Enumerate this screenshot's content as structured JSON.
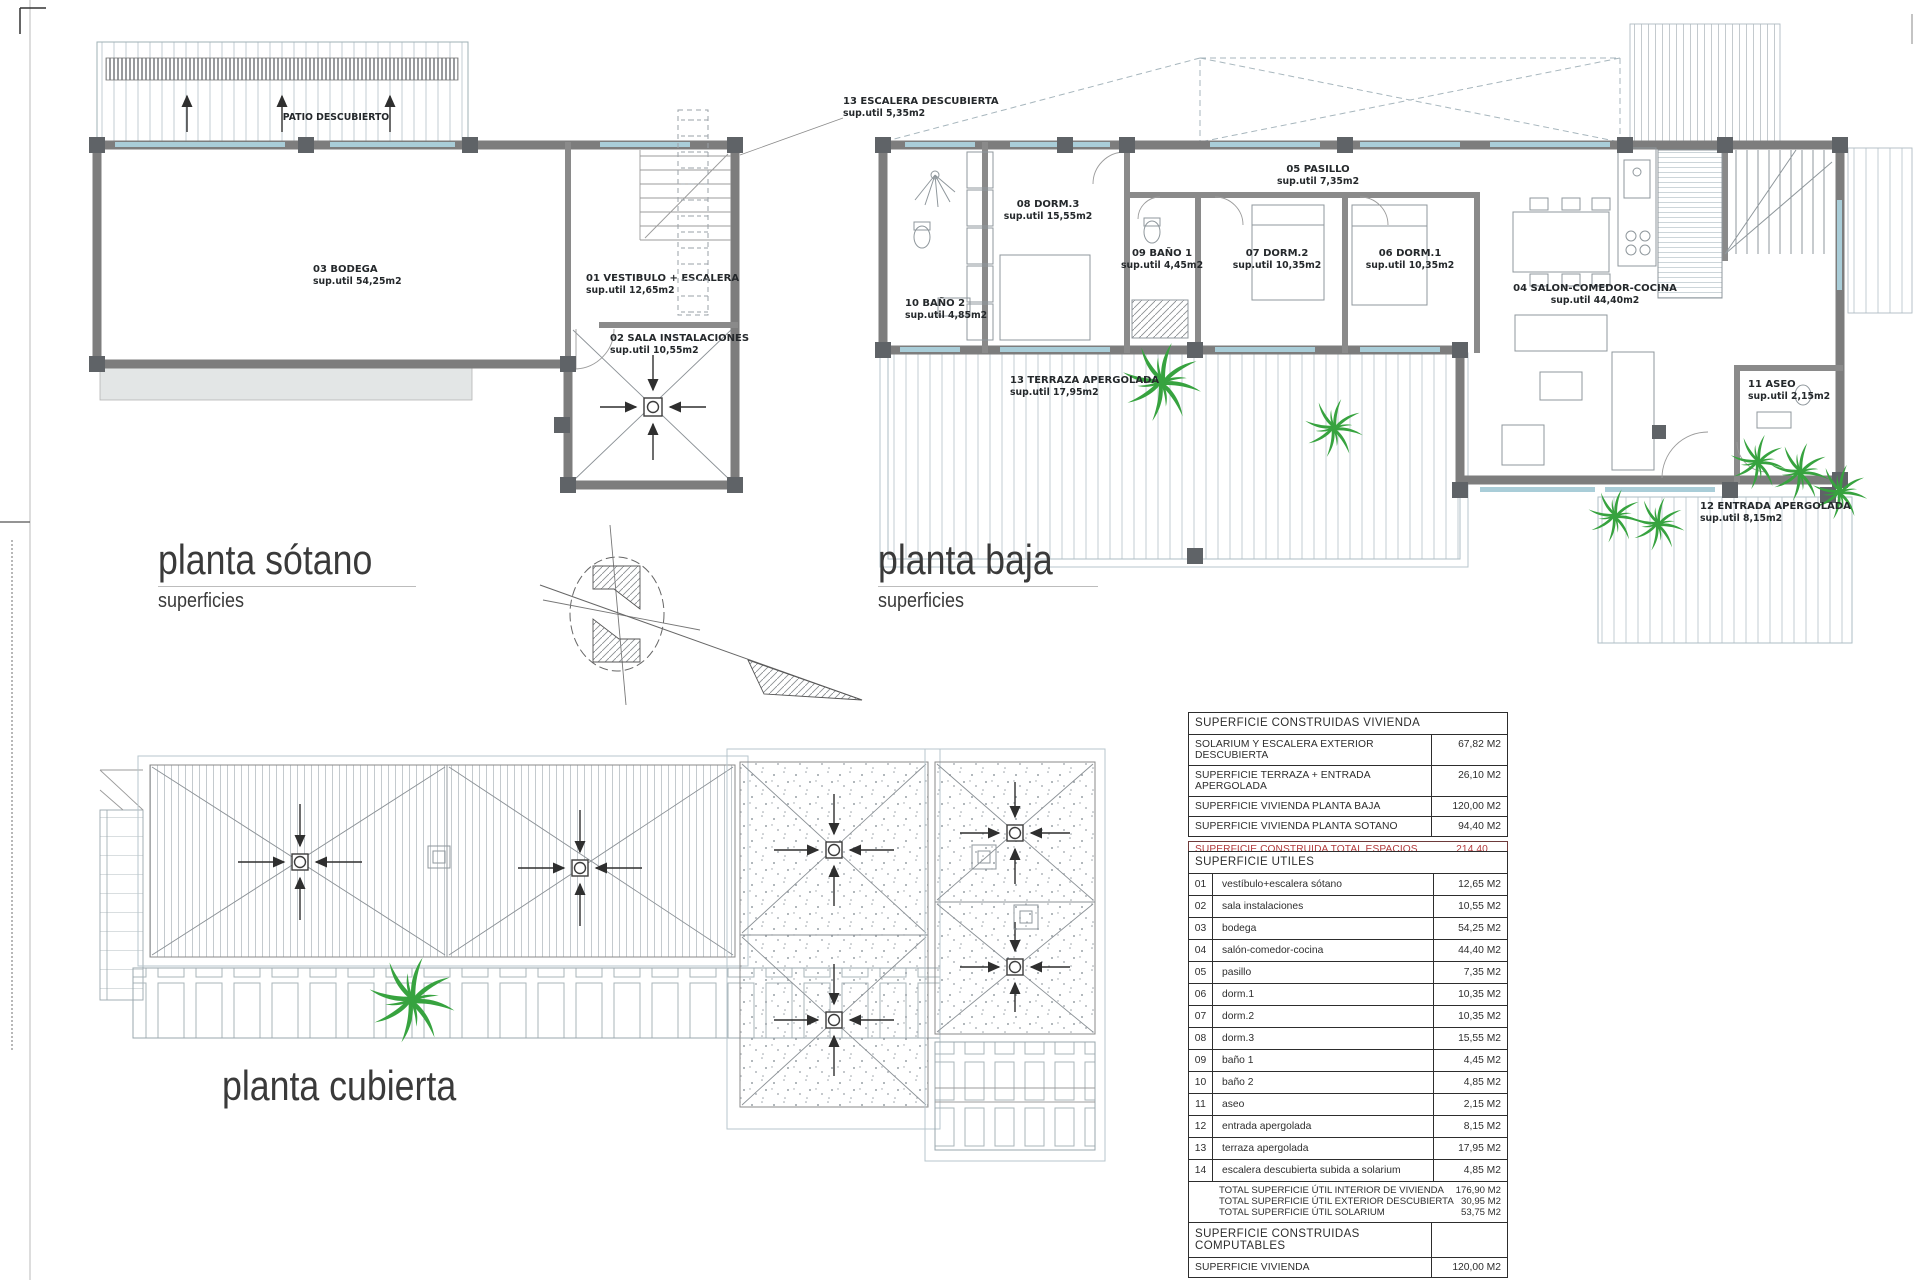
{
  "colors": {
    "plant_green": "#37a33f",
    "total_red": "#b23a3c",
    "wall_gray": "#7d7d7d",
    "window_blue": "#a9cdd8"
  },
  "titles": {
    "sotano_title": "planta sótano",
    "sotano_subtitle": "superficies",
    "baja_title": "planta baja",
    "baja_subtitle": "superficies",
    "cubierta_title": "planta cubierta"
  },
  "sotano_plan": {
    "patio_label": "PATIO DESCUBIERTO",
    "rooms": [
      {
        "name": "03 BODEGA",
        "area": "sup.util 54,25m2"
      },
      {
        "name": "01 VESTIBULO + ESCALERA",
        "area": "sup.util 12,65m2"
      },
      {
        "name": "02 SALA INSTALACIONES",
        "area": "sup.util 10,55m2"
      }
    ]
  },
  "baja_plan": {
    "rooms": [
      {
        "name": "13 ESCALERA DESCUBIERTA",
        "area": "sup.util 5,35m2"
      },
      {
        "name": "08 DORM.3",
        "area": "sup.util 15,55m2"
      },
      {
        "name": "05 PASILLO",
        "area": "sup.util 7,35m2"
      },
      {
        "name": "09 BAÑO 1",
        "area": "sup.util 4,45m2"
      },
      {
        "name": "07 DORM.2",
        "area": "sup.util 10,35m2"
      },
      {
        "name": "06 DORM.1",
        "area": "sup.util 10,35m2"
      },
      {
        "name": "04 SALON-COMEDOR-COCINA",
        "area": "sup.util 44,40m2"
      },
      {
        "name": "10 BAÑO 2",
        "area": "sup.util 4,85m2"
      },
      {
        "name": "13 TERRAZA APERGOLADA",
        "area": "sup.util 17,95m2"
      },
      {
        "name": "11 ASEO",
        "area": "sup.util 2,15m2"
      },
      {
        "name": "12 ENTRADA APERGOLADA",
        "area": "sup.util 8,15m2"
      }
    ]
  },
  "tables": {
    "construidas": {
      "header": "SUPERFICIE CONSTRUIDAS VIVIENDA",
      "rows": [
        {
          "label": "SOLARIUM Y ESCALERA EXTERIOR DESCUBIERTA",
          "value": "67,82 M2"
        },
        {
          "label": "SUPERFICIE TERRAZA + ENTRADA APERGOLADA",
          "value": "26,10 M2"
        },
        {
          "label": "SUPERFICIE VIVIENDA PLANTA BAJA",
          "value": "120,00 M2"
        },
        {
          "label": "SUPERFICIE VIVIENDA PLANTA SOTANO",
          "value": "94,40 M2"
        }
      ],
      "total_label": "SUPERFICIE CONSTRUIDA TOTAL ESPACIOS CUBIERTOS",
      "total_value": "214,40 M2"
    },
    "utiles": {
      "header": "SUPERFICIE UTILES",
      "rows": [
        {
          "num": "01",
          "label": "vestíbulo+escalera sótano",
          "value": "12,65 M2"
        },
        {
          "num": "02",
          "label": "sala instalaciones",
          "value": "10,55 M2"
        },
        {
          "num": "03",
          "label": "bodega",
          "value": "54,25 M2"
        },
        {
          "num": "04",
          "label": "salón-comedor-cocina",
          "value": "44,40 M2"
        },
        {
          "num": "05",
          "label": "pasillo",
          "value": "7,35 M2"
        },
        {
          "num": "06",
          "label": "dorm.1",
          "value": "10,35 M2"
        },
        {
          "num": "07",
          "label": "dorm.2",
          "value": "10,35 M2"
        },
        {
          "num": "08",
          "label": "dorm.3",
          "value": "15,55 M2"
        },
        {
          "num": "09",
          "label": "baño 1",
          "value": "4,45 M2"
        },
        {
          "num": "10",
          "label": "baño 2",
          "value": "4,85 M2"
        },
        {
          "num": "11",
          "label": "aseo",
          "value": "2,15 M2"
        },
        {
          "num": "12",
          "label": "entrada apergolada",
          "value": "8,15 M2"
        },
        {
          "num": "13",
          "label": "terraza apergolada",
          "value": "17,95 M2"
        },
        {
          "num": "14",
          "label": "escalera descubierta subida a solarium",
          "value": "4,85 M2"
        }
      ],
      "totals": [
        {
          "label": "TOTAL SUPERFICIE ÚTIL INTERIOR DE VIVIENDA",
          "value": "176,90 M2"
        },
        {
          "label": "TOTAL SUPERFICIE ÚTIL EXTERIOR DESCUBIERTA",
          "value": "30,95 M2"
        },
        {
          "label": "TOTAL SUPERFICIE ÚTIL SOLARIUM",
          "value": "53,75 M2"
        }
      ]
    },
    "computables": {
      "header": "SUPERFICIE CONSTRUIDAS COMPUTABLES",
      "rows": [
        {
          "label": "SUPERFICIE VIVIENDA",
          "value": "120,00 M2"
        }
      ]
    }
  }
}
